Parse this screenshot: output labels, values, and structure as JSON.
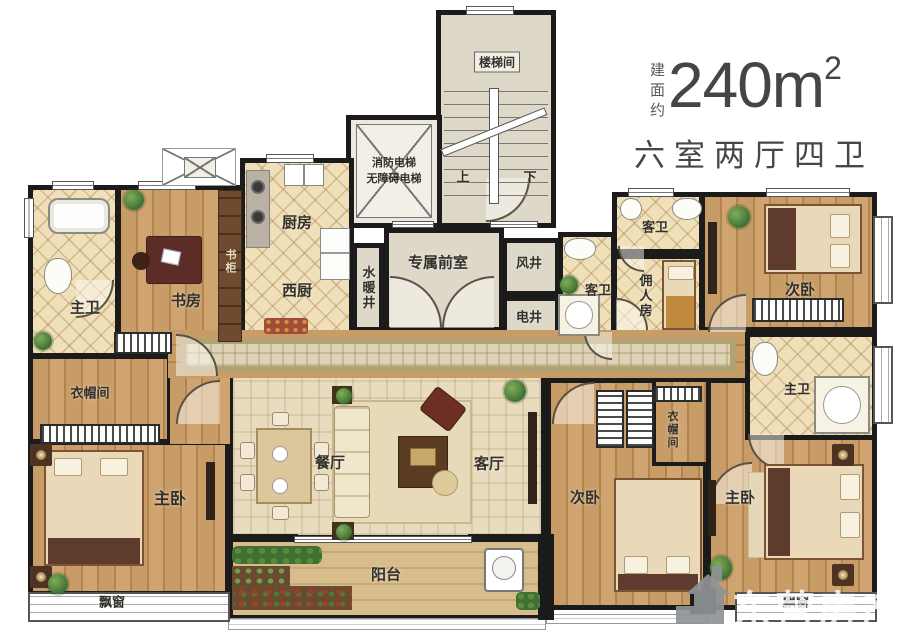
{
  "title": {
    "prefix": "建面约",
    "area": "240m",
    "sup": "2",
    "subtitle": "六室两厅四卫"
  },
  "rooms": {
    "stairwell": "楼梯间",
    "stair_up": "上",
    "stair_down": "下",
    "elevator_line1": "消防电梯",
    "elevator_line2": "无障碍电梯",
    "kitchen": "厨房",
    "west_kitchen": "西厨",
    "water_shaft": "水暖井",
    "front_room": "专属前室",
    "wind_shaft": "风井",
    "elec_shaft": "电井",
    "guest_bath_center": "客卫",
    "guest_bath_top": "客卫",
    "servant_room": "佣人房",
    "bedroom_top_right": "次卧",
    "master_bath_right": "主卫",
    "master_bath_left": "主卫",
    "study": "书房",
    "bookshelf": "书柜",
    "cloak_left": "衣帽间",
    "master_bed_left": "主卧",
    "bay_left": "飘窗",
    "dining": "餐厅",
    "living": "客厅",
    "balcony": "阳台",
    "bedroom_bottom": "次卧",
    "cloak_right": "衣帽间",
    "master_bed_right": "主卧",
    "bay_right": "飘窗"
  },
  "watermark": {
    "text": "东营房产网"
  },
  "colors": {
    "wall": "#1b1b1b",
    "wood_floor": "#c89c66",
    "bath_tile": "#efe0b9",
    "hall_floor": "#ded8c9",
    "mosaic_floor": "#e9dcbe",
    "balcony_floor": "#d7bd8c",
    "title_text": "#454545",
    "watermark_gray": "#8e9396"
  }
}
